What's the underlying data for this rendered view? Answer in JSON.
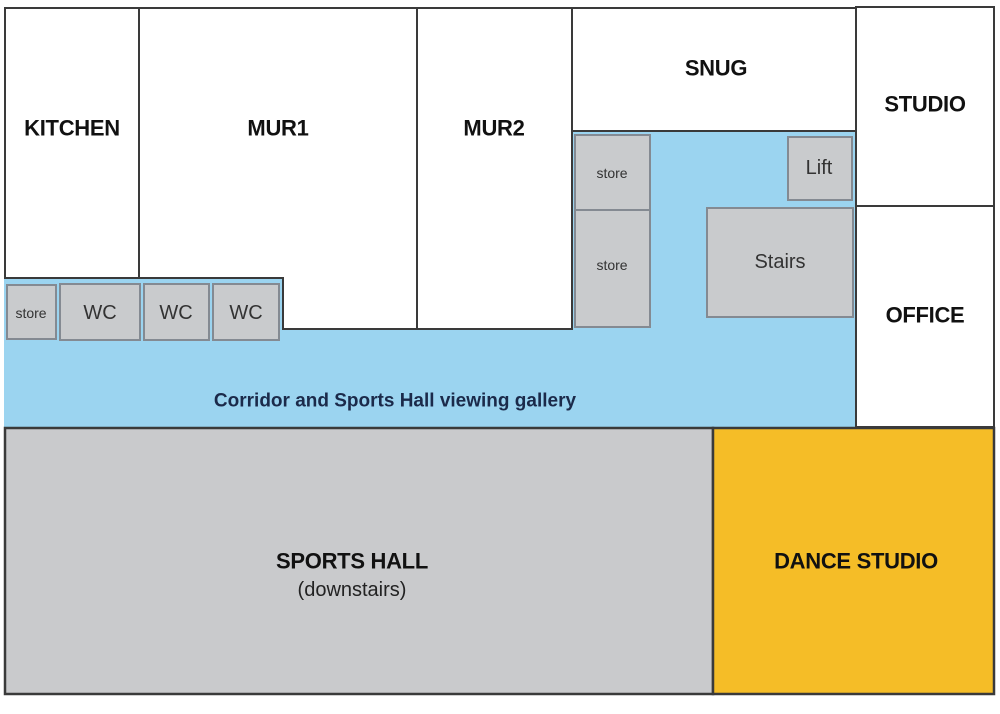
{
  "rooms": {
    "kitchen": {
      "label": "KITCHEN"
    },
    "mur1": {
      "label": "MUR1"
    },
    "mur2": {
      "label": "MUR2"
    },
    "snug": {
      "label": "SNUG"
    },
    "studio": {
      "label": "STUDIO"
    },
    "office": {
      "label": "OFFICE"
    },
    "sports_hall": {
      "label": "SPORTS HALL",
      "sublabel": "(downstairs)"
    },
    "dance_studio": {
      "label": "DANCE STUDIO"
    }
  },
  "features": {
    "store_left": "store",
    "wc_1": "WC",
    "wc_2": "WC",
    "wc_3": "WC",
    "store_upper": "store",
    "store_lower": "store",
    "lift": "Lift",
    "stairs": "Stairs"
  },
  "corridor": {
    "label": "Corridor and Sports Hall viewing gallery"
  },
  "colors": {
    "corridor_blue": "#9BD4F0",
    "feature_gray": "#C9CBCD",
    "feature_gray_border": "#848A92",
    "sports_hall_gray": "#C9CACC",
    "dance_studio_yellow": "#F5BD27",
    "wall": "#3A3A3A",
    "corridor_text": "#1B2A4A"
  }
}
